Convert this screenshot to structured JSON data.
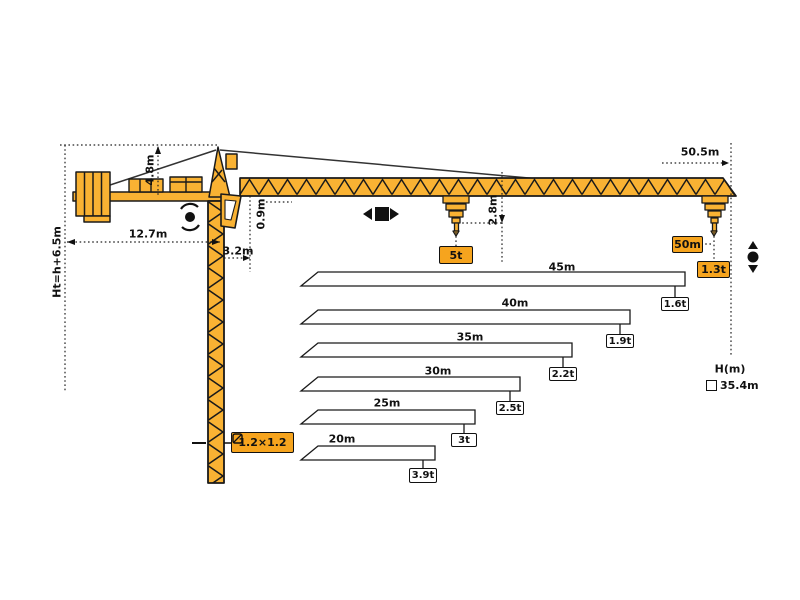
{
  "dimensions": {
    "total_height": "Ht=h+6.5m",
    "apex_height": "4.8m",
    "counter_jib_length": "12.7m",
    "tower_offset": "3.2m",
    "jib_depth": "0.9m",
    "hook_clearance": "2.8m",
    "jib_span": "50.5m"
  },
  "tip": {
    "radius_label": "50m",
    "capacity_label": "1.3t"
  },
  "max_capacity_label": "5t",
  "mast_section_label": "1.2×1.2",
  "height_axis": {
    "label": "H(m)",
    "value": "35.4m"
  },
  "load_chart": {
    "rows": [
      {
        "length": "45m",
        "capacity": "1.6t"
      },
      {
        "length": "40m",
        "capacity": "1.9t"
      },
      {
        "length": "35m",
        "capacity": "2.2t"
      },
      {
        "length": "30m",
        "capacity": "2.5t"
      },
      {
        "length": "25m",
        "capacity": "3t"
      },
      {
        "length": "20m",
        "capacity": "3.9t"
      }
    ]
  },
  "colors": {
    "crane_yellow": "#F9B233",
    "label_orange": "#F6A41E",
    "outline": "#1a1a1a"
  }
}
